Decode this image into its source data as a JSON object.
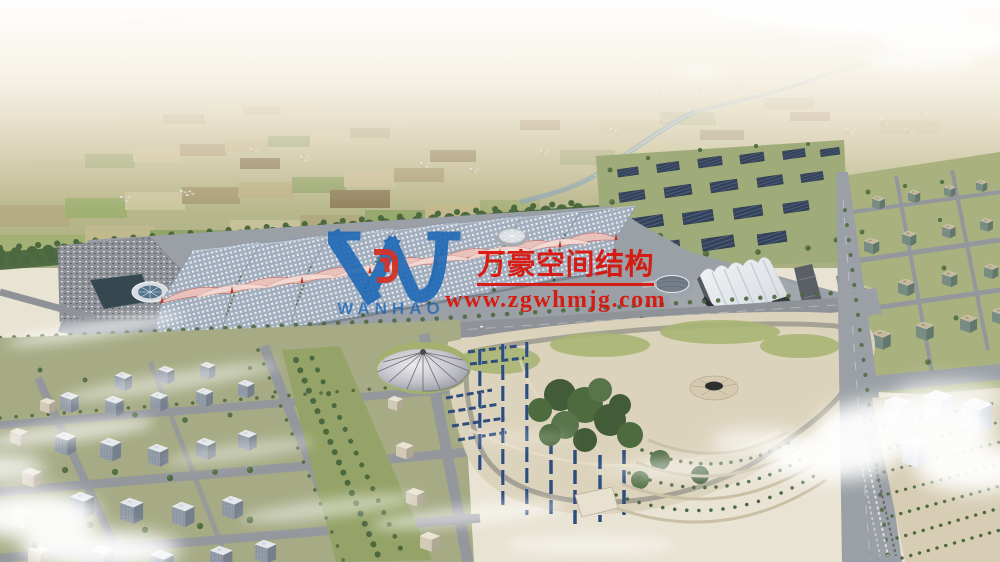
{
  "watermark": {
    "logo_text": "WANHAO",
    "title_cn": "万豪空间结构",
    "url": "www.zgwhmjg.com",
    "text_color": "#d9150c",
    "logo_blue": "#1b67b5",
    "emblem_red": "#d42d20"
  },
  "palette": {
    "hall_roof_base": "#a2aebd",
    "hall_roof_dot": "#eaeef3",
    "membrane_pink": "#ecc3bb",
    "membrane_light": "#f6dcd6",
    "solar_panel_blue": "#2e4c7e",
    "dark_array_navy": "#33415a",
    "park_sand": "#dcd3bc",
    "lawn_green": "#a9b572",
    "tree_green": "#4c683f",
    "farmland_tan": "#cbc49c",
    "road_grey": "#8f9297",
    "canal_blue": "#8fa6ad",
    "cloud_white": "#ffffff"
  }
}
